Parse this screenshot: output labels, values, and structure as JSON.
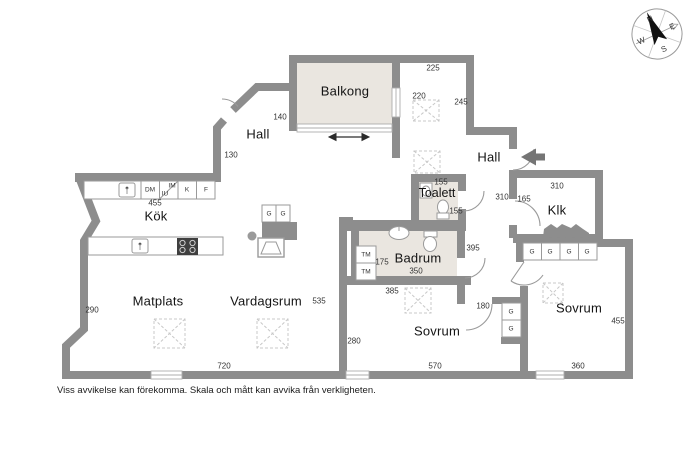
{
  "footer": "Viss avvikelse kan förekomma. Skala och mått kan avvika från verkligheten.",
  "compass": {
    "n": "N",
    "e": "E",
    "s": "S",
    "w": "W"
  },
  "rooms": {
    "balkong": "Balkong",
    "hall_upper": "Hall",
    "hall_entry": "Hall",
    "kok": "Kök",
    "matplats": "Matplats",
    "vardagsrum": "Vardagsrum",
    "toalett": "Toalett",
    "badrum": "Badrum",
    "sovrum_left": "Sovrum",
    "sovrum_right": "Sovrum",
    "klk": "Klk"
  },
  "fixtures": {
    "dm": "DM",
    "im": "IM",
    "iu": "IU",
    "k": "K",
    "f": "F",
    "tm": "TM",
    "g": "G"
  },
  "measurements": {
    "hall_top": "225",
    "balkong_door": "220",
    "hall_right": "245",
    "balkong_side": "140",
    "hall_upper_h": "130",
    "kok_bench": "455",
    "toalett_w": "155",
    "toalett_h": "155",
    "klk_top": "310",
    "klk_side": "310",
    "klk_door": "165",
    "badrum_h": "395",
    "badrum_tm": "175",
    "badrum_w": "350",
    "badrum_bottom": "385",
    "sovrum1_door": "180",
    "sovrum1_h": "280",
    "sovrum1_w": "570",
    "sovrum2_h": "455",
    "sovrum2_w": "360",
    "vardagsrum_w": "535",
    "living_h": "290",
    "living_w": "720"
  },
  "colors": {
    "wall": "#8d8d8d",
    "floor_accent": "#eae6e0"
  }
}
